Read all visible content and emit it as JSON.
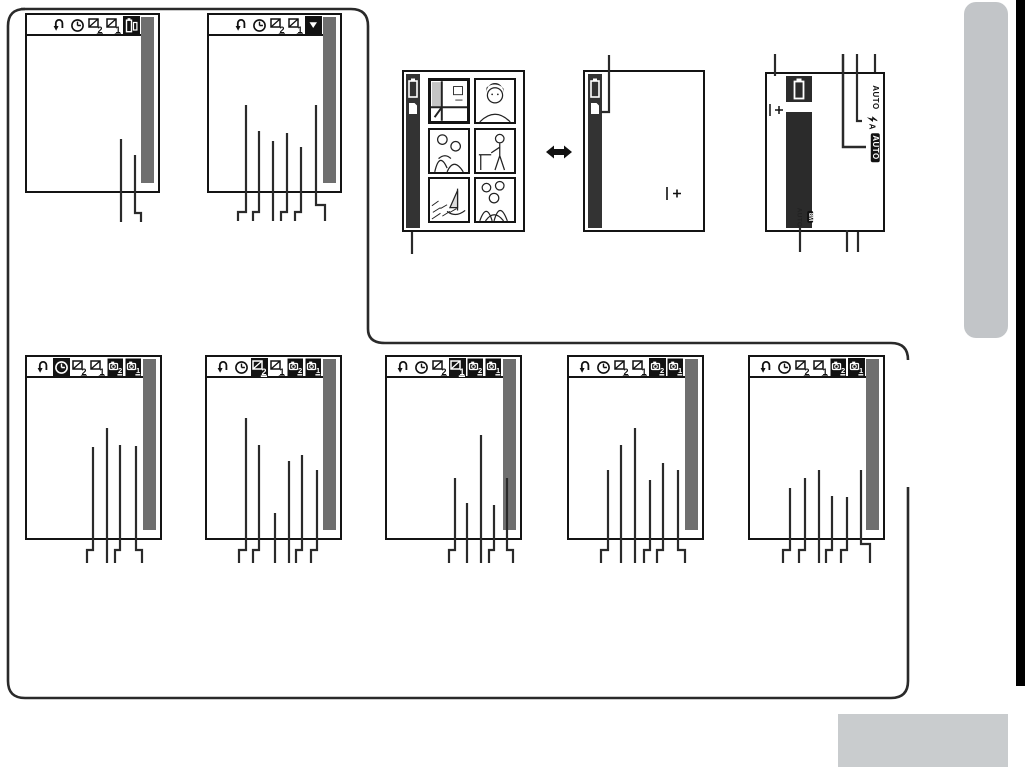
{
  "page": {
    "background": "#ffffff",
    "line_color": "#2a2a2a",
    "border_color": "#141414",
    "graybar_color": "#6f6f6f",
    "darkbar_color": "#333333",
    "side_tab_color": "#c2c5c8",
    "bottom_box_color": "#c9ccce",
    "page_edge_color": "#000000"
  },
  "icon_digits": {
    "frame2": "2",
    "frame1": "1",
    "cam2": "2",
    "cam1": "1"
  },
  "menu_screens": [
    {
      "id": "top-1",
      "x": 25,
      "y": 13,
      "w": 135,
      "h": 180,
      "selected": 4,
      "icons": [
        "return",
        "clock",
        "frame2",
        "frame1",
        "battcard"
      ],
      "callouts": [
        {
          "x": 121,
          "y1": 139,
          "y2": 222
        },
        {
          "x": 135,
          "y1": 155,
          "fy": 213,
          "dx": 6,
          "y2": 222
        }
      ]
    },
    {
      "id": "top-2",
      "x": 207,
      "y": 13,
      "w": 135,
      "h": 180,
      "selected": 4,
      "icons": [
        "return",
        "clock",
        "frame2",
        "frame1",
        "tridown"
      ],
      "callouts": [
        {
          "x": 246,
          "y1": 105,
          "fy": 212,
          "dx": -8,
          "y2": 221
        },
        {
          "x": 259,
          "y1": 131,
          "fy": 212,
          "dx": -6,
          "y2": 221
        },
        {
          "x": 273,
          "y1": 141,
          "y2": 221
        },
        {
          "x": 287,
          "y1": 133,
          "fy": 212,
          "dx": -6,
          "y2": 221
        },
        {
          "x": 301,
          "y1": 147,
          "fy": 212,
          "dx": -6,
          "y2": 221
        },
        {
          "x": 316,
          "y1": 105,
          "fy": 205,
          "dx": 9,
          "y2": 221
        }
      ]
    },
    {
      "id": "bottom-1",
      "x": 25,
      "y": 355,
      "w": 137,
      "h": 185,
      "selected": 1,
      "icons": [
        "return",
        "clock",
        "frame2",
        "frame1",
        "cam2",
        "cam1"
      ],
      "callouts": [
        {
          "x": 93,
          "y1": 447,
          "fy": 550,
          "dx": -6,
          "y2": 563
        },
        {
          "x": 107,
          "y1": 428,
          "y2": 563
        },
        {
          "x": 120,
          "y1": 445,
          "fy": 550,
          "dx": -5,
          "y2": 563
        },
        {
          "x": 136,
          "y1": 446,
          "fy": 550,
          "dx": 6,
          "y2": 563
        }
      ]
    },
    {
      "id": "bottom-2",
      "x": 205,
      "y": 355,
      "w": 137,
      "h": 185,
      "selected": 2,
      "icons": [
        "return",
        "clock",
        "frame2",
        "frame1",
        "cam2",
        "cam1"
      ],
      "callouts": [
        {
          "x": 246,
          "y1": 418,
          "fy": 550,
          "dx": -7,
          "y2": 563
        },
        {
          "x": 259,
          "y1": 445,
          "fy": 550,
          "dx": -6,
          "y2": 563
        },
        {
          "x": 275,
          "y1": 513,
          "y2": 563
        },
        {
          "x": 289,
          "y1": 461,
          "y2": 563
        },
        {
          "x": 302,
          "y1": 455,
          "fy": 550,
          "dx": -6,
          "y2": 563
        },
        {
          "x": 317,
          "y1": 470,
          "fy": 550,
          "dx": -6,
          "y2": 563
        }
      ]
    },
    {
      "id": "bottom-3",
      "x": 385,
      "y": 355,
      "w": 137,
      "h": 185,
      "selected": 3,
      "icons": [
        "return",
        "clock",
        "frame2",
        "frame1",
        "cam2",
        "cam1"
      ],
      "callouts": [
        {
          "x": 455,
          "y1": 478,
          "fy": 550,
          "dx": -6,
          "y2": 563
        },
        {
          "x": 467,
          "y1": 503,
          "y2": 563
        },
        {
          "x": 481,
          "y1": 435,
          "y2": 563
        },
        {
          "x": 494,
          "y1": 505,
          "fy": 550,
          "dx": -5,
          "y2": 563
        },
        {
          "x": 507,
          "y1": 478,
          "fy": 550,
          "dx": 6,
          "y2": 563
        }
      ]
    },
    {
      "id": "bottom-4",
      "x": 567,
      "y": 355,
      "w": 137,
      "h": 185,
      "selected": 4,
      "icons": [
        "return",
        "clock",
        "frame2",
        "frame1",
        "cam2",
        "cam1"
      ],
      "callouts": [
        {
          "x": 608,
          "y1": 470,
          "fy": 550,
          "dx": -7,
          "y2": 563
        },
        {
          "x": 621,
          "y1": 445,
          "y2": 563
        },
        {
          "x": 635,
          "y1": 428,
          "y2": 563
        },
        {
          "x": 650,
          "y1": 480,
          "fy": 550,
          "dx": -6,
          "y2": 563
        },
        {
          "x": 663,
          "y1": 463,
          "fy": 550,
          "dx": -6,
          "y2": 563
        },
        {
          "x": 678,
          "y1": 470,
          "fy": 550,
          "dx": 7,
          "y2": 563
        }
      ]
    },
    {
      "id": "bottom-5",
      "x": 748,
      "y": 355,
      "w": 137,
      "h": 185,
      "selected": 5,
      "icons": [
        "return",
        "clock",
        "frame2",
        "frame1",
        "cam2",
        "cam1"
      ],
      "callouts": [
        {
          "x": 790,
          "y1": 488,
          "fy": 550,
          "dx": -7,
          "y2": 563
        },
        {
          "x": 805,
          "y1": 478,
          "fy": 550,
          "dx": -6,
          "y2": 563
        },
        {
          "x": 819,
          "y1": 470,
          "y2": 563
        },
        {
          "x": 832,
          "y1": 496,
          "fy": 550,
          "dx": -6,
          "y2": 563
        },
        {
          "x": 847,
          "y1": 497,
          "fy": 550,
          "dx": -6,
          "y2": 563
        },
        {
          "x": 861,
          "y1": 470,
          "fy": 544,
          "dx": 9,
          "y2": 563
        }
      ]
    }
  ],
  "scene_screen": {
    "thumbs": [
      {
        "art": "building-interior",
        "selected": true
      },
      {
        "art": "portrait-face",
        "selected": false
      },
      {
        "art": "couple",
        "selected": false
      },
      {
        "art": "person-standing",
        "selected": false
      },
      {
        "art": "boat-landscape",
        "selected": false
      },
      {
        "art": "group-photo",
        "selected": false
      }
    ]
  },
  "blank_screen": {
    "center_mark": "|+"
  },
  "auto_screen": {
    "mode_label": "AUTO",
    "flash_label": "A",
    "badge_label": "AUTO",
    "size_text": "AUTO",
    "size_badge": "8M",
    "center_mark": "|+"
  },
  "diagram": {
    "outline_paths": [
      "M21,9 H351 Q368,9 368,26 V329 Q368,343 385,343 H891 Q908,343 908,360",
      "M908,487 V681 Q908,698 891,698 H25 Q8,698 8,681 V26 Q8,9 25,9"
    ],
    "extra_callouts": [
      {
        "name": "scene-screen-callout",
        "d": "M412,232 V254",
        "w": 2.2
      },
      {
        "name": "card-icon-callout",
        "d": "M601,112 H609 V55",
        "w": 2.2
      },
      {
        "name": "battery-callout",
        "d": "M775,54 V76",
        "w": 2.2
      },
      {
        "name": "auto-badge-callout",
        "d": "M843,54 V147 H866",
        "w": 2.5
      },
      {
        "name": "flash-callout",
        "d": "M857,54 V121 H862",
        "w": 2.2
      },
      {
        "name": "mode-label-callout",
        "d": "M875,54 V72",
        "w": 2.2
      },
      {
        "name": "size-indicator-callout",
        "d": "M800,228 V252",
        "w": 2.2
      },
      {
        "name": "bottom-callout-2",
        "d": "M847,230 V252",
        "w": 2.2
      },
      {
        "name": "bottom-callout-3",
        "d": "M858,232 V252",
        "w": 2.2
      }
    ]
  }
}
